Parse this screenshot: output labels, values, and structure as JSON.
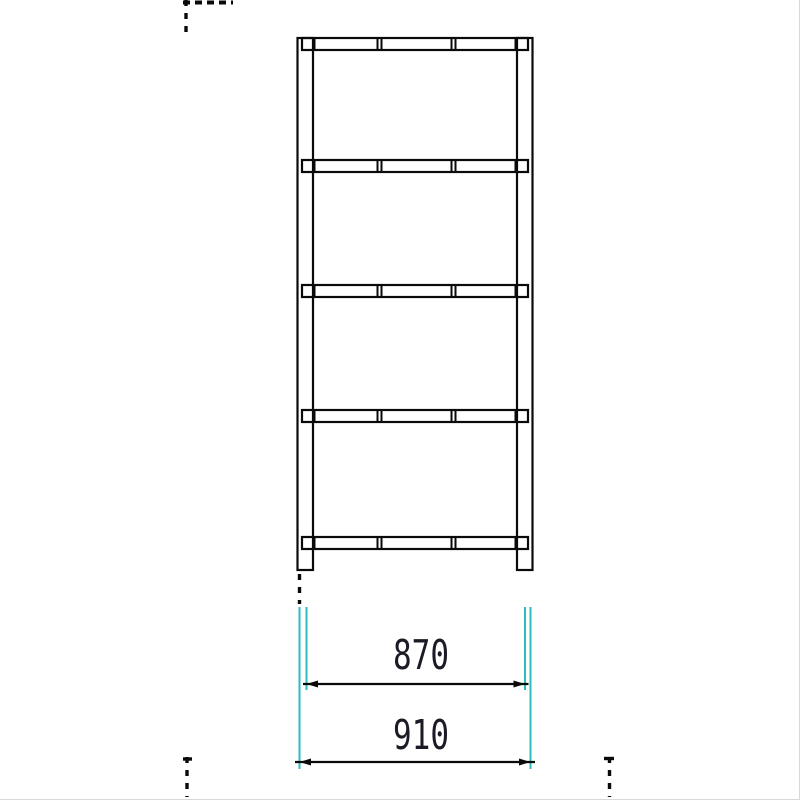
{
  "drawing": {
    "kind": "steel-rack-front-elevation",
    "shelf_tiers": 5,
    "post_count": 2
  },
  "colors": {
    "line": "#0a0a0a",
    "extension_line": "#2bbcc0",
    "dimension_text": "#1b1b26",
    "background": "#ffffff"
  },
  "dimensions": {
    "inner_width": {
      "label": "870"
    },
    "overall_width": {
      "label": "910"
    }
  }
}
